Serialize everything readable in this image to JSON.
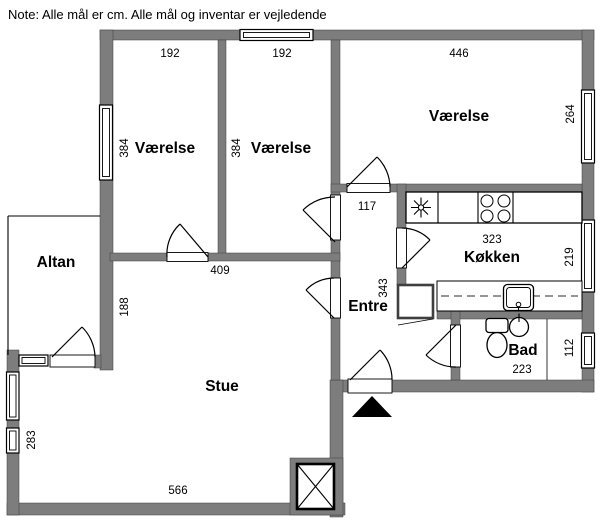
{
  "note": "Note: Alle mål er cm. Alle mål og inventar er vejledende",
  "colors": {
    "wall": "#7d7d7d",
    "line": "#000000",
    "background": "#ffffff"
  },
  "rooms": {
    "vaerelse1": {
      "label": "Værelse",
      "width": "192",
      "depth": "384"
    },
    "vaerelse2": {
      "label": "Værelse",
      "width": "192",
      "depth": "384"
    },
    "vaerelse3": {
      "label": "Værelse",
      "width": "446",
      "depth": "264"
    },
    "koekken": {
      "label": "Køkken",
      "width": "323",
      "depth": "219"
    },
    "bad": {
      "label": "Bad",
      "width": "223",
      "depth": "112"
    },
    "entre": {
      "label": "Entre",
      "depth": "343",
      "hall_width": "117"
    },
    "stue": {
      "label": "Stue",
      "width": "566",
      "depth": "283",
      "upper_width": "409",
      "altan_wall": "188"
    },
    "altan": {
      "label": "Altan"
    }
  },
  "icons": {
    "cooktop": "four-burner-cooktop",
    "kitchen_star": "appliance-star-symbol",
    "kitchen_sink": "kitchen-sink",
    "toilet": "toilet",
    "washbasin": "round-washbasin",
    "shaft": "crossed-shaft-box",
    "entrance_marker": "black-triangle-entrance-arrow",
    "window": "double-line-window",
    "door": "quarter-arc-door-swing"
  }
}
